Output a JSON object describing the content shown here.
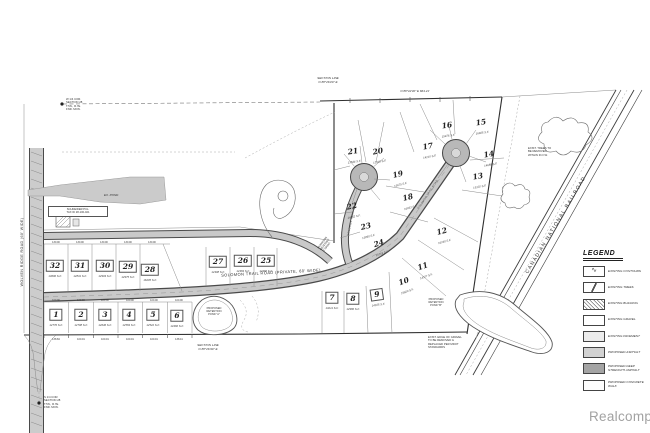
{
  "watermark": "Realcomp",
  "roads": {
    "main": "SOLOMON TRAIL ROAD (PRIVATE, 60' WIDE)",
    "west": "WOLVEN RIDGE ROAD (60' WIDE)",
    "railroad": "CANADIAN NATIONAL RAILROAD",
    "court": "SOLOMON TRAIL ROAD"
  },
  "plan": {
    "north_bearing": "N 88°42'30\" E   664.21'",
    "lots": [
      {
        "num": "1",
        "area": "12770 S.F."
      },
      {
        "num": "2",
        "area": "12708 S.F."
      },
      {
        "num": "3",
        "area": "12646 S.F."
      },
      {
        "num": "4",
        "area": "12584 S.F."
      },
      {
        "num": "5",
        "area": "12522 S.F."
      },
      {
        "num": "6",
        "area": "14460 S.F."
      },
      {
        "num": "7",
        "area": "13211 S.F."
      },
      {
        "num": "8",
        "area": "12980 S.F."
      },
      {
        "num": "9",
        "area": "14105 S.F."
      },
      {
        "num": "10",
        "area": "15820 S.F."
      },
      {
        "num": "11",
        "area": "14377 S.F."
      },
      {
        "num": "12",
        "area": "16240 S.F."
      },
      {
        "num": "13",
        "area": "15102 S.F."
      },
      {
        "num": "14",
        "area": "14688 S.F."
      },
      {
        "num": "15",
        "area": "16925 S.F."
      },
      {
        "num": "16",
        "area": "15476 S.F."
      },
      {
        "num": "17",
        "area": "14210 S.F."
      },
      {
        "num": "18",
        "area": "16033 S.F."
      },
      {
        "num": "19",
        "area": "13675 S.F."
      },
      {
        "num": "20",
        "area": "12918 S.F."
      },
      {
        "num": "21",
        "area": "13544 S.F."
      },
      {
        "num": "22",
        "area": "14262 S.F."
      },
      {
        "num": "23",
        "area": "13890 S.F."
      },
      {
        "num": "24",
        "area": "15718 S.F."
      },
      {
        "num": "25",
        "area": "12460 S.F."
      },
      {
        "num": "26",
        "area": "12384 S.F."
      },
      {
        "num": "27",
        "area": "12308 S.F."
      },
      {
        "num": "28",
        "area": "16205 S.F."
      },
      {
        "num": "29",
        "area": "12975 S.F."
      },
      {
        "num": "30",
        "area": "12903 S.F."
      },
      {
        "num": "31",
        "area": "12831 S.F."
      },
      {
        "num": "32",
        "area": "13690 S.F."
      }
    ],
    "dims_top": [
      "130.00",
      "130.00",
      "130.00",
      "130.00",
      "130.00"
    ],
    "dims_mid": [
      "100.00",
      "100.00",
      "100.00",
      "100.00",
      "100.00",
      "100.00"
    ],
    "south_dims": [
      "138.84",
      "100.01",
      "100.01",
      "100.01",
      "100.01",
      "138.41"
    ]
  },
  "legend": {
    "title": "LEGEND",
    "items": [
      {
        "label": "EXISTING CONTOURS",
        "swatch": "contours"
      },
      {
        "label": "EXISTING TREES",
        "swatch": "slash"
      },
      {
        "label": "EXISTING BUILDING",
        "swatch": "hatch"
      },
      {
        "label": "EXISTING GRAVEL",
        "swatch": "plain"
      },
      {
        "label": "EXISTING PAVEMENT",
        "swatch": "light"
      },
      {
        "label": "PROPOSED ASPHALT",
        "swatch": "mid"
      },
      {
        "label": "PROPOSED DEEP\nSTRENGTH ASPHALT",
        "swatch": "dark"
      },
      {
        "label": "PROPOSED CONCRETE WALK",
        "swatch": "walk"
      }
    ]
  },
  "annotations": {
    "west_corner": "W 1/4 COR.\nSECTION 28\nT.5N., R.7E.\nFND. MON.",
    "south_corner": "S 1/4 COR.\nSECTION 28\nT.5N., R.7E.\nFND. MON.",
    "section_top": "SECTION LINE\nN 88°26'20\" E",
    "section_bottom": "SECTION LINE\nN 88°26'40\" E",
    "railroad_note": "EXIST. TREES TO\nBE REMOVED\nWITHIN R.O.W.",
    "gravel_note": "EXIST. EDGE OF GRAVEL\nTO BE REMOVED &\nREPLACED PER MDOT\nSTANDARDS",
    "parcel_label": "SCHNEIDER PCL.\nTAX ID 28-100-021",
    "condo_note": "MORRISON\nMEADOWS\nCONDO.",
    "ex_pond": "EX. POND",
    "pond_a": "PROPOSED\nRETENTION\nPOND \"A\"",
    "pond_b": "PROPOSED\nRETENTION\nPOND \"B\""
  }
}
